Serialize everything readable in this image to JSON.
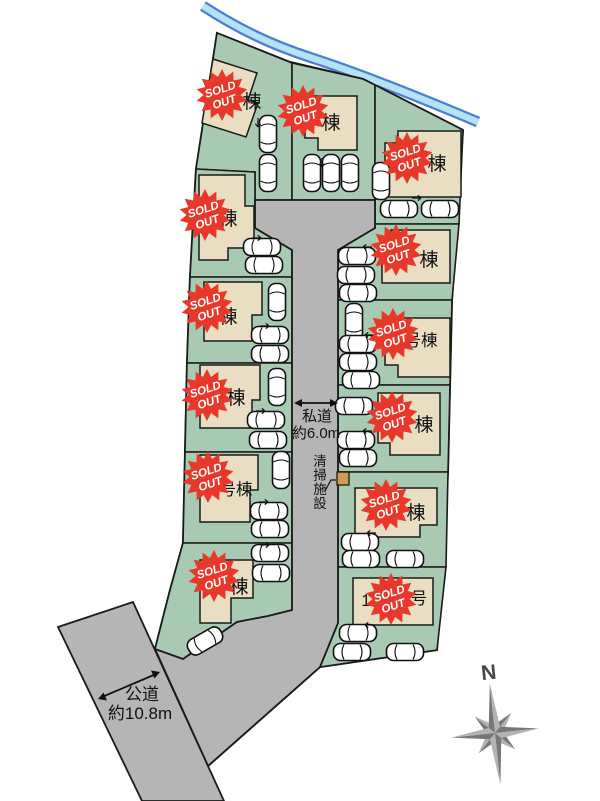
{
  "map": {
    "badge": {
      "line1": "SOLD",
      "line2": "OUT"
    },
    "private_road": {
      "name": "私道",
      "width": "約6.0m"
    },
    "public_road": {
      "name": "公道",
      "width": "約10.8m"
    },
    "cleaning_facility": {
      "c0": "清",
      "c1": "掃",
      "c2": "施",
      "c3": "設"
    },
    "compass": {
      "north": "N"
    },
    "lots": [
      {
        "label": "棟"
      },
      {
        "label": "棟"
      },
      {
        "label": "棟"
      },
      {
        "label": "棟"
      },
      {
        "label": "棟"
      },
      {
        "label": "棟"
      },
      {
        "label": "号棟"
      },
      {
        "label": "棟"
      },
      {
        "label": "棟"
      },
      {
        "label": "号棟"
      },
      {
        "label": "棟"
      },
      {
        "label": "棟"
      },
      {
        "label_left": "1",
        "label": "号"
      }
    ]
  },
  "colors": {
    "site_green": "#a8c9b2",
    "house_beige": "#e9ddc2",
    "road_gray": "#b5b5b5",
    "badge_red": "#e8382a",
    "river_blue": "#4a7fd0",
    "river_light": "#b4e2f6",
    "outline": "#1a1a1a",
    "facility_tan": "#cf9b57",
    "compass_dark": "#777777",
    "compass_light": "#b3b3b3"
  }
}
